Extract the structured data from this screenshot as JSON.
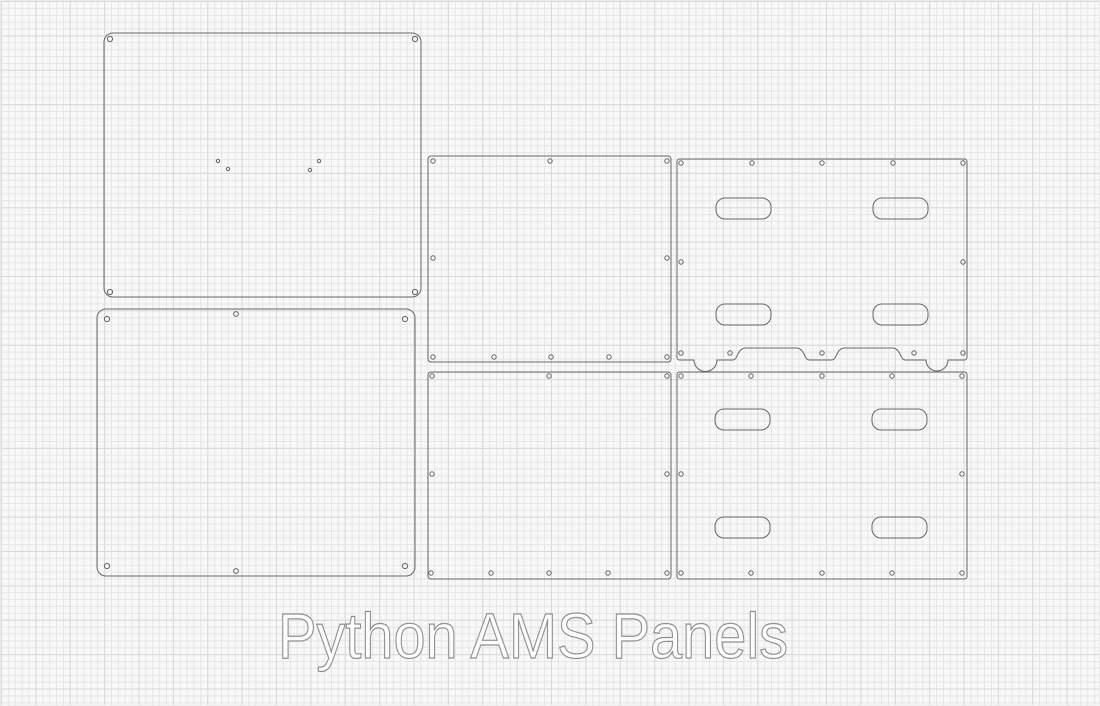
{
  "title": "Python AMS Panels",
  "canvas": {
    "width": 1100,
    "height": 706
  },
  "style": {
    "background": "#f8f8f8",
    "grid_minor_color": "#e5e5e5",
    "grid_major_color": "#d9d9d9",
    "outline_color": "#666666",
    "outline_width": 1,
    "text_fill": "#fcfcfc",
    "text_stroke": "#909090"
  },
  "panels": [
    {
      "name": "top-cover",
      "x": 103,
      "y": 32,
      "w": 317,
      "h": 264,
      "rx": 9,
      "holes": [
        [
          109,
          38,
          2.6
        ],
        [
          414,
          38,
          2.6
        ],
        [
          109,
          291,
          2.6
        ],
        [
          414,
          291,
          2.6
        ],
        [
          217,
          160,
          1.7
        ],
        [
          227,
          168,
          1.7
        ],
        [
          309,
          169,
          1.7
        ],
        [
          318,
          160,
          1.7
        ]
      ],
      "slots": []
    },
    {
      "name": "bottom-cover",
      "x": 96,
      "y": 308,
      "w": 318,
      "h": 267,
      "rx": 9,
      "holes": [
        [
          106,
          318,
          2.6
        ],
        [
          404,
          318,
          2.6
        ],
        [
          106,
          565,
          2.6
        ],
        [
          404,
          565,
          2.6
        ],
        [
          235,
          313,
          2.4
        ],
        [
          235,
          570,
          2.4
        ]
      ],
      "slots": []
    },
    {
      "name": "side-panel-top",
      "x": 427,
      "y": 155,
      "w": 243,
      "h": 206,
      "rx": 3,
      "holes": [
        [
          432,
          160,
          2.2
        ],
        [
          549,
          160,
          2.2
        ],
        [
          666,
          160,
          2.2
        ],
        [
          432,
          257,
          2.2
        ],
        [
          666,
          257,
          2.2
        ],
        [
          432,
          356,
          2.2
        ],
        [
          493,
          356,
          2.2
        ],
        [
          550,
          356,
          2.2
        ],
        [
          608,
          356,
          2.2
        ],
        [
          666,
          356,
          2.2
        ]
      ],
      "slots": []
    },
    {
      "name": "side-panel-bottom",
      "x": 427,
      "y": 371,
      "w": 243,
      "h": 207,
      "rx": 3,
      "holes": [
        [
          431,
          375,
          2.2
        ],
        [
          548,
          375,
          2.2
        ],
        [
          666,
          375,
          2.2
        ],
        [
          431,
          473,
          2.2
        ],
        [
          666,
          473,
          2.2
        ],
        [
          430,
          572,
          2.2
        ],
        [
          490,
          572,
          2.2
        ],
        [
          548,
          572,
          2.2
        ],
        [
          607,
          572,
          2.2
        ],
        [
          666,
          572,
          2.2
        ]
      ],
      "slots": []
    },
    {
      "name": "slotted-panel-top",
      "x": 676,
      "y": 158,
      "w": 290,
      "h": 201,
      "rx": 2.5,
      "holes": [
        [
          680,
          162,
          2.2
        ],
        [
          751,
          162,
          2.2
        ],
        [
          821,
          162,
          2.2
        ],
        [
          892,
          162,
          2.2
        ],
        [
          962,
          162,
          2.2
        ],
        [
          680,
          261,
          2.2
        ],
        [
          962,
          261,
          2.2
        ],
        [
          680,
          352,
          2.2
        ],
        [
          729,
          352,
          2.2
        ],
        [
          821,
          352,
          2.2
        ],
        [
          913,
          352,
          2.2
        ],
        [
          962,
          352,
          2.2
        ]
      ],
      "slots": [
        [
          715,
          197,
          55,
          21,
          9
        ],
        [
          872,
          197,
          55,
          21,
          9
        ],
        [
          715,
          303,
          55,
          21,
          9
        ],
        [
          872,
          303,
          55,
          21,
          9
        ]
      ],
      "bottom_notches": {
        "depth": 12,
        "items": [
          {
            "type": "semicircle",
            "x1": 693,
            "x2": 716
          },
          {
            "type": "plateau",
            "x1": 738,
            "x2": 802
          },
          {
            "type": "plateau",
            "x1": 837,
            "x2": 898
          },
          {
            "type": "semicircle",
            "x1": 925,
            "x2": 947
          }
        ]
      }
    },
    {
      "name": "slotted-panel-bottom",
      "x": 676,
      "y": 371,
      "w": 290,
      "h": 207,
      "rx": 2.5,
      "holes": [
        [
          680,
          375,
          2.2
        ],
        [
          750,
          375,
          2.2
        ],
        [
          821,
          375,
          2.2
        ],
        [
          891,
          375,
          2.2
        ],
        [
          961,
          375,
          2.2
        ],
        [
          680,
          473,
          2.2
        ],
        [
          961,
          473,
          2.2
        ],
        [
          680,
          572,
          2.2
        ],
        [
          750,
          572,
          2.2
        ],
        [
          821,
          572,
          2.2
        ],
        [
          891,
          572,
          2.2
        ],
        [
          961,
          572,
          2.2
        ]
      ],
      "slots": [
        [
          714,
          408,
          55,
          21,
          9
        ],
        [
          871,
          408,
          55,
          21,
          9
        ],
        [
          714,
          516,
          55,
          21,
          9
        ],
        [
          871,
          516,
          55,
          21,
          9
        ]
      ]
    }
  ],
  "caption": {
    "x": 277,
    "baseline": 657,
    "text_length": 510
  }
}
